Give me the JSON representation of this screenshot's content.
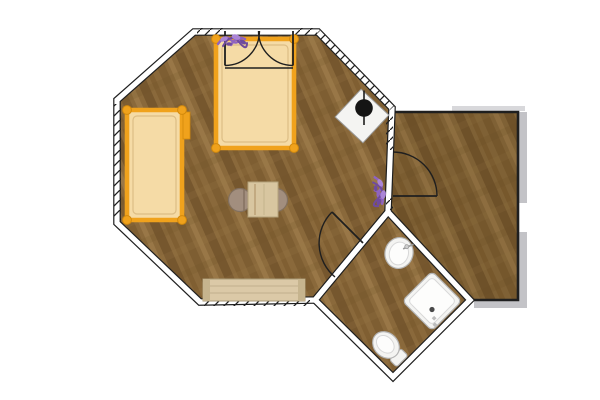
{
  "scene": {
    "type": "floor-plan",
    "view": "top-down-2d",
    "description": "Octagonal cabin with attached side room and diamond bathroom",
    "background": "#ffffff"
  },
  "colors": {
    "wall_line": "#1f1f1f",
    "wall_fill": "#ffffff",
    "wood_base": "#8a693b",
    "wood_dark": "#6e5129",
    "wood_mid": "#7d5c30",
    "wood_light": "#9c7a4a",
    "bed_frame": "#f0a21c",
    "bed_frame_dark": "#d2890c",
    "mattress": "#f5dba6",
    "mattress_edge": "#dcbd85",
    "table": "#d8c6a0",
    "table_edge": "#b4a37c",
    "chair": "#a28e7e",
    "chair_edge": "#82705f",
    "rug": "#dbc9a7",
    "rug_cap": "#c6b48e",
    "rug_edge": "#a99a77",
    "fixture_white": "#f4f4f2",
    "fixture_edge": "#b5b5b5",
    "shadow_gray": "#c3c3c7",
    "plant_main": "#8f63c0",
    "plant_light": "#ab85d6",
    "plant_dark": "#6f4a9e"
  },
  "rooms": [
    {
      "name": "main-room",
      "shape": "octagon",
      "floor": "wood",
      "points": "194,32 318,32 392,108 388,212 315,300 200,302 117,223 117,100"
    },
    {
      "name": "side-room",
      "shape": "pentagon",
      "floor": "wood",
      "points": "392,112 518,112 518,300 470,300 388,212"
    },
    {
      "name": "bathroom",
      "shape": "diamond",
      "floor": "wood",
      "points": "388,212 470,300 393,377 315,300"
    }
  ],
  "windows": [
    {
      "name": "window-left-wall",
      "points": "114,104 121,104 121,220 114,220"
    },
    {
      "name": "window-bottom-wall",
      "points": "204,299 310,299 310,306 204,306"
    },
    {
      "name": "window-top-left",
      "points": "197,28 223,28 223,35 197,35"
    },
    {
      "name": "window-top-right",
      "points": "295,28 317,28 317,35 295,35"
    },
    {
      "name": "window-ne-diagonal",
      "points": "315.5,34.4 389.5,110.4 394.5,105.6 320.5,29.6"
    },
    {
      "name": "window-right-upper",
      "points": "386,114 393,114 393,150 386,150"
    },
    {
      "name": "window-right-lower",
      "points": "386,198 393,198 393,210 386,210"
    }
  ],
  "doors": [
    {
      "name": "entrance-door-left",
      "type": "french-double",
      "leaf": "M 225,31 L 225,65.5",
      "arc": "M 225,65.5 A 34.5,34.5 0 0 0 259.5,31"
    },
    {
      "name": "entrance-door-right",
      "type": "french-double",
      "leaf": "M 293,31 L 293,65.5",
      "arc": "M 293,65.5 A 34.5,34.5 0 0 1 258.5,31"
    },
    {
      "name": "side-room-door",
      "type": "single-swing",
      "leaf": "M 393,196 L 437,196",
      "arc": "M 437,196 A 44,44 0 0 0 393,152"
    },
    {
      "name": "bathroom-door",
      "type": "single-swing",
      "leaf": "M 363,243 L 332,212",
      "arc": "M 332,212 A 44,44 0 0 0 335,277"
    }
  ],
  "threshold_line": "M 225,68 L 293,68",
  "furniture": [
    {
      "name": "double-bed",
      "room": "main-room",
      "rect": [
        216,
        39,
        78,
        109
      ]
    },
    {
      "name": "single-bed",
      "room": "main-room",
      "rect": [
        127,
        110,
        55,
        110
      ]
    },
    {
      "name": "dining-table",
      "room": "main-room",
      "rect": [
        248,
        182,
        30,
        35
      ]
    },
    {
      "name": "chair-left",
      "room": "main-room",
      "center": [
        240,
        200
      ],
      "radius": 11.5
    },
    {
      "name": "chair-right",
      "room": "main-room",
      "center": [
        276,
        200
      ],
      "radius": 11.5
    },
    {
      "name": "rug",
      "room": "main-room",
      "rect": [
        203,
        279,
        102,
        22
      ]
    },
    {
      "name": "wood-stove",
      "room": "main-room",
      "center": [
        362,
        116
      ],
      "size": 38,
      "rotation": 43
    },
    {
      "name": "plant-entrance",
      "room": "main-room",
      "center": [
        233,
        41
      ]
    },
    {
      "name": "plant-side-wall",
      "room": "main-room",
      "center": [
        379,
        192
      ]
    },
    {
      "name": "bathroom-sink",
      "room": "bathroom",
      "center": [
        399,
        253
      ]
    },
    {
      "name": "shower",
      "room": "bathroom",
      "center": [
        432,
        301
      ],
      "size": 42,
      "rotation": 45
    },
    {
      "name": "toilet",
      "room": "bathroom",
      "center": [
        386,
        345
      ],
      "rotation": -45
    }
  ]
}
